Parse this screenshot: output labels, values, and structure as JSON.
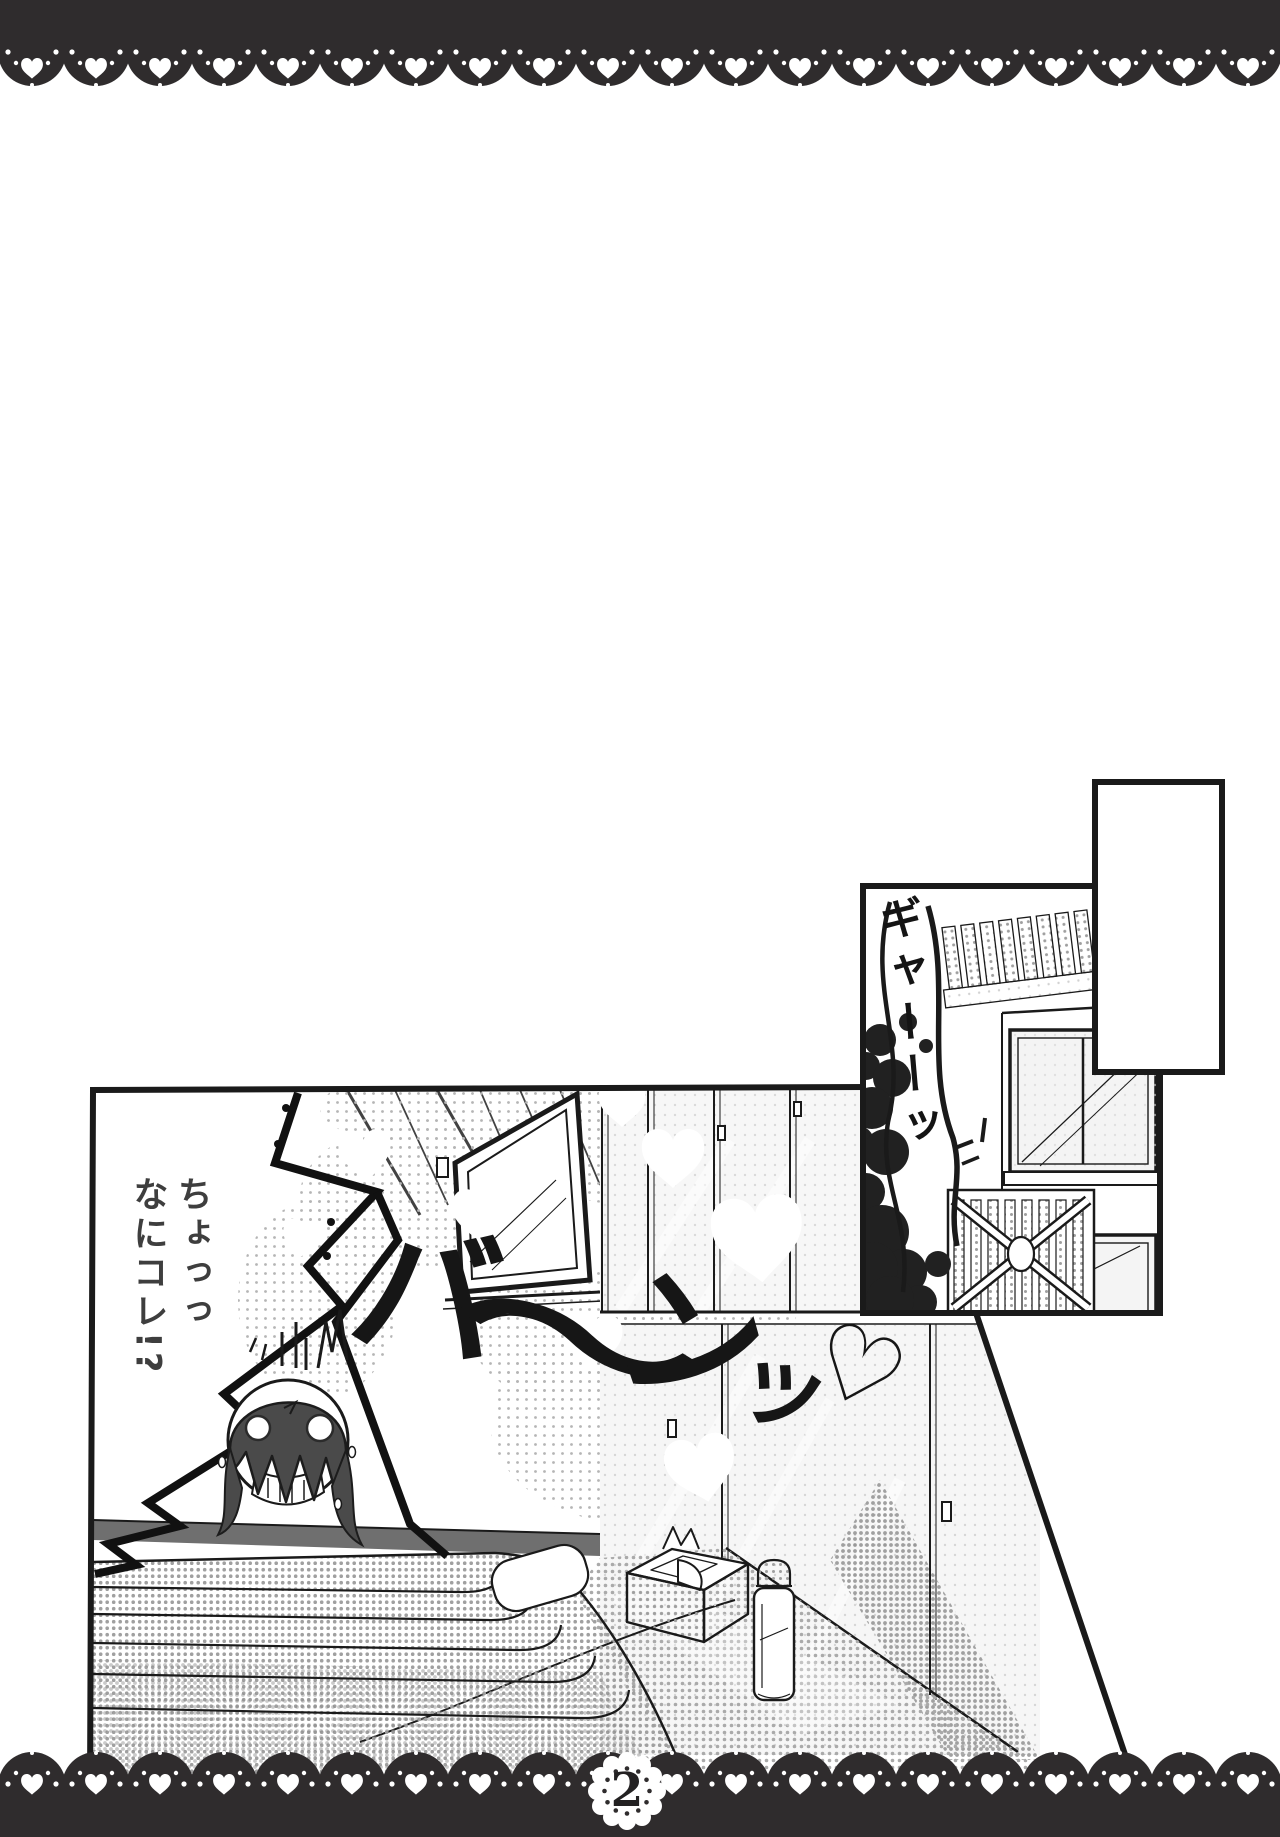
{
  "page": {
    "number": "2",
    "paper_color": "#ffffff",
    "ink_color": "#1a1a1a",
    "lace_color": "#2f2c2d"
  },
  "main_panel": {
    "dialogue": {
      "right_column": "ちょっっ",
      "left_column": "なにコレ!?"
    },
    "sfx_bang": {
      "text": "バ〜ンッ♡",
      "ba": "バ",
      "wave": "〜",
      "n": "ン",
      "tsu": "ッ",
      "heart": "♡"
    },
    "scene": "bedroom-with-closet-window-bed"
  },
  "insert_panel": {
    "sfx_scream": {
      "text": "ギャーーッ"
    },
    "scene": "house-exterior-fence-trees-gate"
  }
}
